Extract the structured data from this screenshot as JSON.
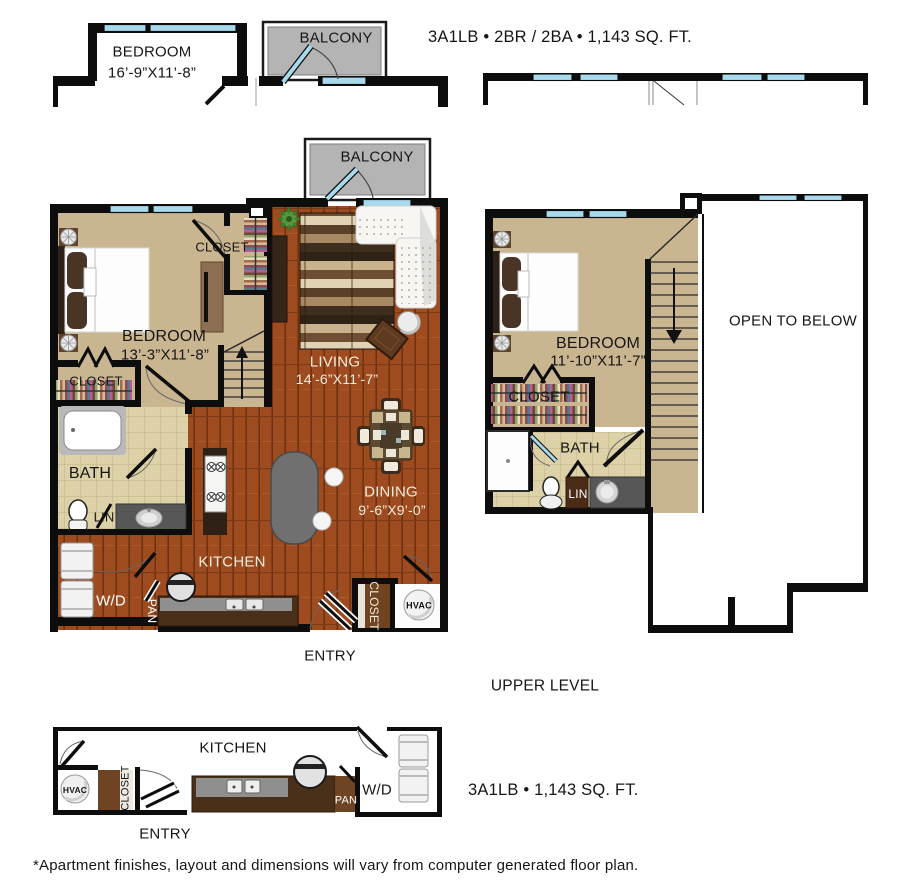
{
  "title": "3A1LB • 2BR / 2BA • 1,143 SQ. FT.",
  "footer": "*Apartment finishes, layout and dimensions will vary from computer generated floor plan.",
  "upper_level_caption": "UPPER LEVEL",
  "bottom_title": "3A1LB • 1,143 SQ. FT.",
  "labels": {
    "bedroom_top": "BEDROOM",
    "bedroom_top_dims": "16’-9”X11’-8”",
    "balcony_top": "BALCONY",
    "balcony_main": "BALCONY",
    "closet_tr": "CLOSET",
    "bedroom_main": "BEDROOM",
    "bedroom_main_dims": "13’-3”X11’-8”",
    "closet_bl": "CLOSET",
    "living": "LIVING",
    "living_dims": "14’-6”X11’-7”",
    "bath_main": "BATH",
    "lin_main": "LIN",
    "wd_main": "W/D",
    "pan_main": "PAN",
    "kitchen_main": "KITCHEN",
    "dining": "DINING",
    "dining_dims": "9’-6”X9’-0”",
    "closet_entry": "CLOSET",
    "hvac_main": "HVAC",
    "entry_main": "ENTRY",
    "bedroom_upper": "BEDROOM",
    "bedroom_upper_dims": "11’-10”X11’-7”",
    "closet_upper": "CLOSET",
    "bath_upper": "BATH",
    "lin_upper": "LIN",
    "open_to_below": "OPEN TO BELOW",
    "kitchen_bottom": "KITCHEN",
    "hvac_bottom": "HVAC",
    "closet_bottom": "CLOSET",
    "entry_bottom": "ENTRY",
    "pan_bottom": "PAN",
    "wd_bottom": "W/D"
  },
  "colors": {
    "wall": "#0d0d0d",
    "window_glass": "#a9d9ec",
    "balcony_gray": "#b4b4b4",
    "wood_floor": "#9e4b20",
    "carpet_tan": "#c9b690",
    "bath_tile": "#ddd1a7",
    "counter_brown": "#4a3018",
    "countertop_gray": "#8f8f8f",
    "island_gray": "#707070"
  }
}
